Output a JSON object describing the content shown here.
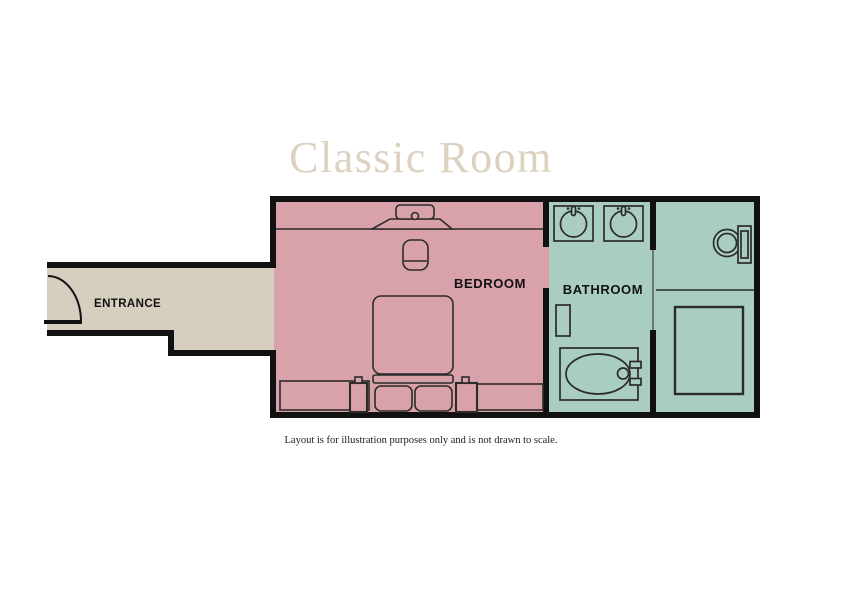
{
  "title": {
    "text": "Classic Room",
    "color": "#ddd1c0"
  },
  "caption": "Layout is for illustration purposes only and is not drawn to scale.",
  "rooms": {
    "entrance": {
      "label": "ENTRANCE",
      "fill": "#d6cebf"
    },
    "bedroom": {
      "label": "BEDROOM",
      "fill": "#d9a2ab"
    },
    "bathroom": {
      "label": "BATHROOM",
      "fill": "#a9cec0"
    }
  },
  "colors": {
    "wall": "#111111",
    "outline": "#2b2b2b",
    "label_text": "#111111",
    "background": "#ffffff"
  }
}
